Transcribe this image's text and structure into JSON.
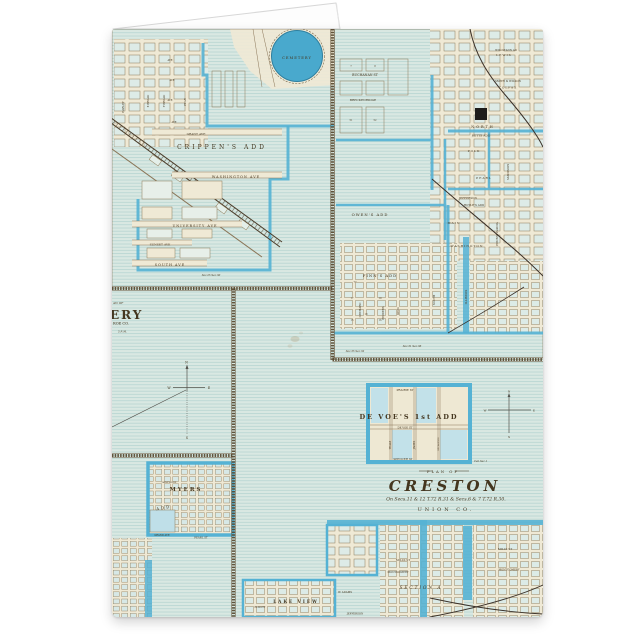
{
  "colors": {
    "page_bg": "#ffffff",
    "map_cream": "#efe9d5",
    "ruled_blue": "#d9e8e2",
    "street_blue": "#55b2d4",
    "cemetery_blue": "#49a9cd",
    "line_sepia": "#8a7557",
    "ink": "#44361f"
  },
  "map": {
    "topLeftPlat": {
      "cemetery": "CEMETERY",
      "crippens_add": "CRIPPEN'S ADD",
      "grant_ave": "GRANT AVE",
      "washington_ave": "WASHINGTON AVE",
      "university_ave": "UNIVERSITY AVE",
      "sunset_ave": "SUNSET AVE",
      "south_ave": "SOUTH AVE",
      "harley_st": "HARLEY",
      "e_broad_st": "E BROAD",
      "f_broad_st": "F BROAD",
      "pear_st": "PEAR",
      "ave1": "AVE",
      "ave2": "AVE",
      "ave3": "AVE",
      "ave4": "AVE",
      "sec_note": "Sec.25  Sec.30"
    },
    "averyPanel": {
      "line1": "AN OF",
      "line2": "ERY",
      "line3": "ROE CO.",
      "line4": "5 P. M.",
      "compass": {
        "n": "N",
        "e": "E",
        "s": "S",
        "w": "W"
      }
    },
    "crestonPlat": {
      "willstann": "WILLSTANN AD",
      "lewis": "LEWIS",
      "buchanan": "BUCHANAN  ST",
      "smith_wilson": "SMITH & WILSON",
      "colfax": "COLFAX",
      "breckenridge": "BRECKENRIDGE",
      "north": "NORTH",
      "retts_add": "RETTS ADD",
      "polk": "POLK",
      "pearl": "PEARL",
      "madison": "MADISON",
      "jefferson": "JEFFERSON",
      "hoyles_add": "HOYLE'S ADD",
      "main": "MAIN",
      "washington": "WASHINGTON",
      "pennsylvania": "PENNSYLVANIA",
      "illinois": "ILLINOIS",
      "owens_add": "OWEN'S  ADD",
      "finns_add": "FINN'S  ADD",
      "orchard": "ORCHARD",
      "pinders": "PINDERS",
      "king": "KING",
      "south": "SOUTH",
      "sec_note1": "Sec.31  Sec.36",
      "sec_note2": "Sec.35  Sec.32"
    },
    "blockNumbers": [
      "7",
      "8",
      "51",
      "52",
      "77",
      "17",
      "18",
      "19",
      "15",
      "16"
    ],
    "devoesPlat": {
      "prairie": "PRAIRIE  ST",
      "title": "DE VOE'S 1st ADD",
      "devoe": "DE VOE  ST",
      "spencer": "SPENCER  ST",
      "teale": "TEALE",
      "james": "JAMES",
      "sycamore": "SYCAMORE",
      "cen_sec": "Cen.Sec.1",
      "compass": {
        "n": "N",
        "e": "E",
        "s": "S",
        "w": "W"
      }
    },
    "titleBlock": {
      "plan_of": "PLAN OF",
      "name": "CRESTON",
      "sections": "On Secs.11 & 12 T.72 R.31 & Secs.6 & 7 T.72 R.30.",
      "county": "UNION  CO."
    },
    "southPlats": {
      "lake_view": "LAKE VIEW",
      "section_a": "SECTION  A",
      "mills_1": "MILLS  ST",
      "montgomery_1": "MONTGOMERY",
      "mills_2": "MILLS  ST",
      "montgomery_2": "MONTGOMERY",
      "adams": "W. ADAMS",
      "jefferson": "JEFFERSON",
      "elliott": "ELLIOTT"
    },
    "myersPlat": {
      "hampshire": "HAMPSHIRE",
      "name": "MYERS",
      "add": "ADD",
      "grand_ave": "GRAND AVE",
      "pearl_st": "PEARL  ST"
    }
  }
}
